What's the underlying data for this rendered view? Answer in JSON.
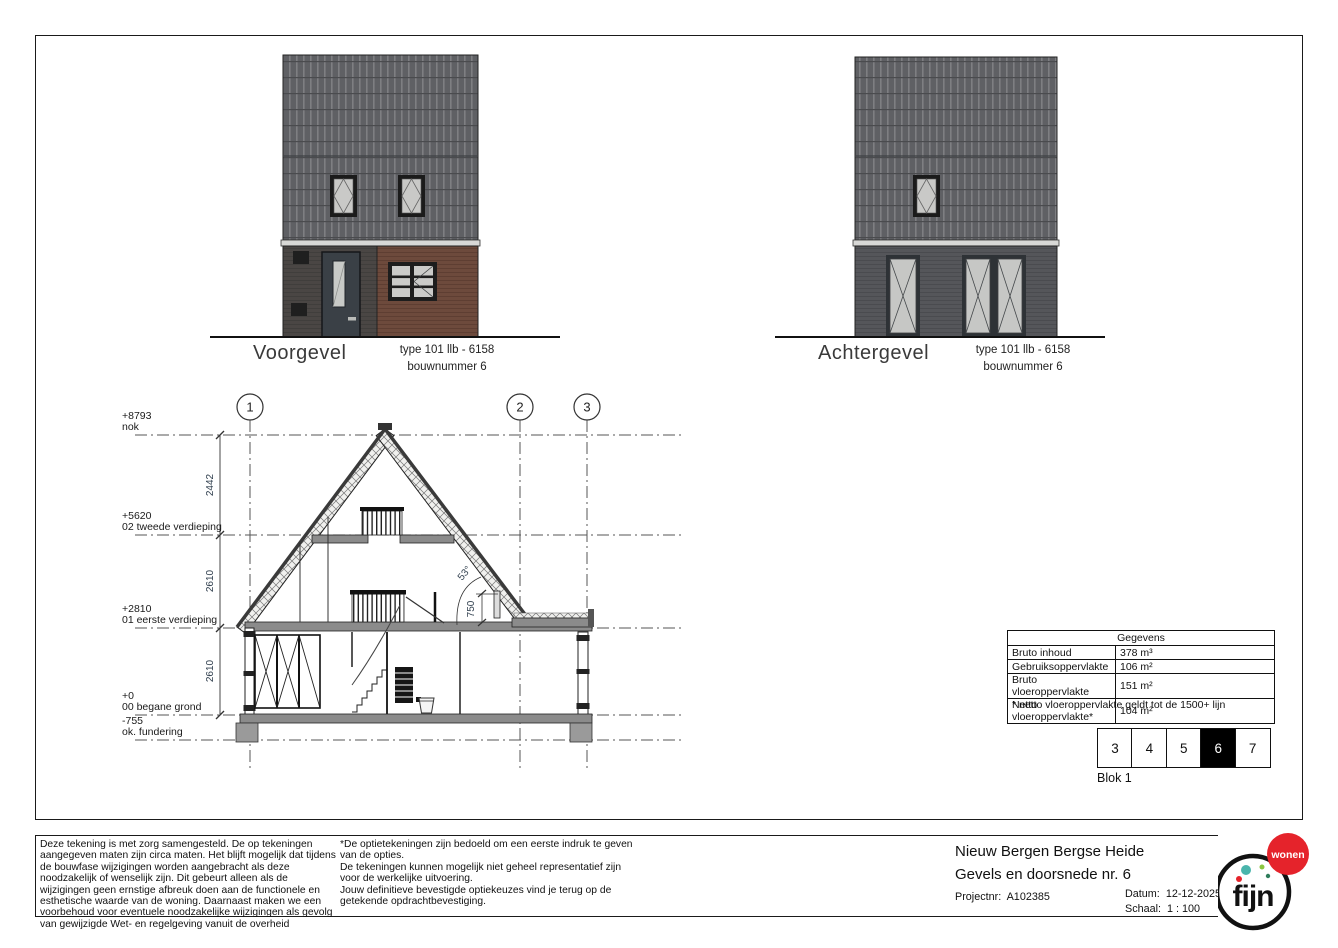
{
  "elevations": {
    "front": {
      "title": "Voorgevel",
      "type_line": "type 101 llb - 6158",
      "bouwnummer_line": "bouwnummer 6"
    },
    "rear": {
      "title": "Achtergevel",
      "type_line": "type 101 llb - 6158",
      "bouwnummer_line": "bouwnummer 6"
    }
  },
  "section": {
    "grid_labels": [
      "1",
      "2",
      "3"
    ],
    "levels": [
      {
        "elevation": "+8793",
        "name": "nok"
      },
      {
        "elevation": "+5620",
        "name": "02 tweede verdieping"
      },
      {
        "elevation": "+2810",
        "name": "01 eerste verdieping"
      },
      {
        "elevation": "+0",
        "name": "00 begane grond"
      },
      {
        "elevation": "-755",
        "name": "ok. fundering"
      }
    ],
    "dimensions": [
      "2442",
      "2610",
      "2610",
      "750"
    ],
    "roof_angle": "53°"
  },
  "gegevens_table": {
    "title": "Gegevens",
    "rows": [
      {
        "label": "Bruto inhoud",
        "value": "378 m³"
      },
      {
        "label": "Gebruiksoppervlakte",
        "value": "106 m²"
      },
      {
        "label": "Bruto vloeroppervlakte",
        "value": "151 m²"
      },
      {
        "label": "Netto vloeroppervlakte*",
        "value": "104 m²"
      }
    ],
    "footnote": "* netto vloeroppervlakte geldt tot de 1500+ lijn"
  },
  "block_strip": {
    "numbers": [
      "3",
      "4",
      "5",
      "6",
      "7"
    ],
    "active": "6",
    "label": "Blok 1"
  },
  "footer": {
    "disclaimer": "Deze tekening is met zorg samengesteld. De op tekeningen aangegeven maten zijn circa maten. Het blijft mogelijk dat tijdens de bouwfase wijzigingen worden aangebracht als deze noodzakelijk of wenselijk zijn. Dit gebeurt alleen als de wijzigingen geen ernstige afbreuk doen aan de functionele en esthetische waarde van de woning. Daarnaast maken we een voorbehoud voor eventuele noodzakelijke wijzigingen als gevolg van gewijzigde Wet- en regelgeving vanuit de overheid",
    "options_note": "*De optietekeningen zijn bedoeld om een eerste indruk te geven van de opties.\nDe tekeningen kunnen mogelijk niet geheel representatief zijn voor de werkelijke uitvoering.\nJouw definitieve bevestigde optiekeuzes vind je terug op de getekende opdrachtbevestiging.",
    "project_title": "Nieuw Bergen Bergse Heide",
    "drawing_title": "Gevels en doorsnede nr. 6",
    "project_number_label": "Projectnr:",
    "project_number": "A102385",
    "date_label": "Datum:",
    "date": "12-12-2025",
    "scale_label": "Schaal:",
    "scale": "1 : 100",
    "logo_text": "fijn",
    "logo_badge": "wonen"
  },
  "colors": {
    "roof_gray": "#5f6064",
    "brick_red": "#6d4a3c",
    "brick_dark": "#4a4644",
    "brick_gray": "#55565a",
    "accent_red": "#e5232b",
    "logo_teal": "#4ab5ac",
    "logo_green": "#8bc53f"
  }
}
